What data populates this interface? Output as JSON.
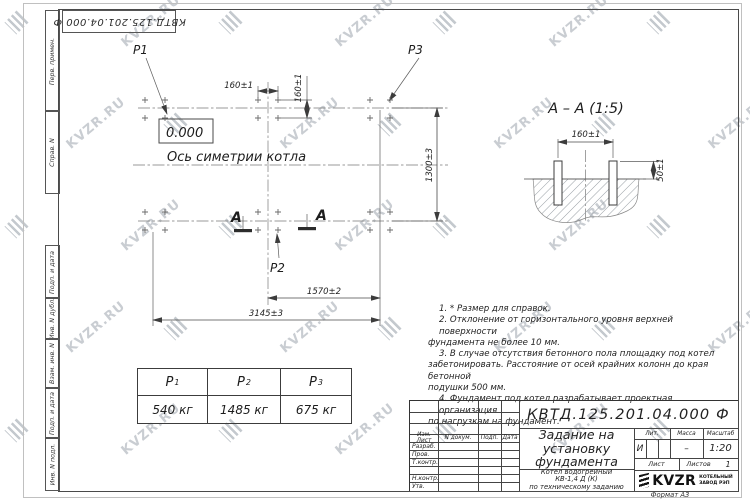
{
  "watermark": {
    "text": "KVZR.RU"
  },
  "stamp_top": "КВТД.125.201.04.000  Ф",
  "margin_labels": [
    "Перв. примен.",
    "Справ. N",
    "Подп. и дата",
    "Инв. N дубл.",
    "Взам. инв. N",
    "Подп. и дата",
    "Инв. N подл."
  ],
  "plan": {
    "p1": "P1",
    "p2": "P2",
    "p3": "P3",
    "elevation": "0.000",
    "axis_label": "Ось симетрии котла",
    "section_letter": "А",
    "dims": {
      "bolt_x": "160±1",
      "bolt_y": "160±1",
      "rows": "1300±3",
      "half": "1570±2",
      "full": "3145±3"
    }
  },
  "section": {
    "title": "А – А (1:5)",
    "dim_bolts": "160±1",
    "dim_height": "50±1"
  },
  "load_table": {
    "headers": [
      {
        "label": "P",
        "sub": "1"
      },
      {
        "label": "P",
        "sub": "2"
      },
      {
        "label": "P",
        "sub": "3"
      }
    ],
    "values": [
      "540 кг",
      "1485 кг",
      "675 кг"
    ]
  },
  "notes": {
    "lines": [
      "1. * Размер для справок.",
      "2. Отклонение от горизонтального уровня верхней поверхности",
      "фундамента не более 10 мм.",
      "3. В случае отсутствия бетонного пола площадку под котел",
      "забетонировать. Расстояние от осей крайних колонн до края бетонной",
      "подушки 500 мм.",
      "4. Фундамент под котел разрабатывает проектная организация",
      "по нагрузкам на фундамент."
    ]
  },
  "title_block": {
    "designation": "КВТД.125.201.04.000  Ф",
    "title_lines": [
      "Задание на",
      "установку",
      "фундамента"
    ],
    "product_lines": [
      "Котел водогрейный",
      "КВ-1,4  Д (К)",
      "по техническому заданию"
    ],
    "header_cells": [
      "Изм. Лист",
      "N докум.",
      "Подп.",
      "Дата"
    ],
    "sign_rows": [
      "Разраб.",
      "Пров.",
      "Т.контр.",
      "Н.контр.",
      "Утв."
    ],
    "lit_label": "Лит.",
    "mass_label": "Масса",
    "scale_label": "Масштаб",
    "lit_value": "И",
    "mass_value": "–",
    "scale_value": "1:20",
    "sheet_label": "Лист",
    "sheets_label": "Листов",
    "sheets_value": "1",
    "logo_text": "KVZR",
    "logo_caption_lines": [
      "КОТЕЛЬНЫЙ",
      "ЗАВОД РЭП"
    ]
  },
  "format_label": "Формат А3"
}
